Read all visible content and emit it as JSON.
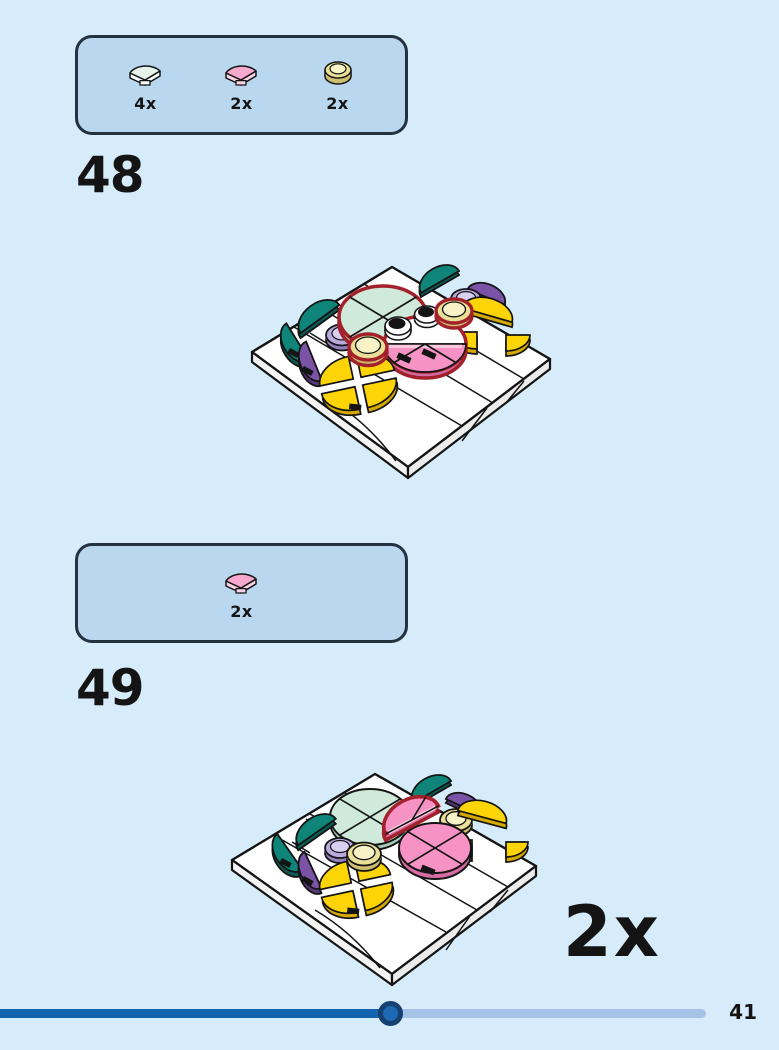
{
  "page": {
    "number": "41"
  },
  "palette": {
    "pageBg": "#d7ecfa",
    "boxBg": "#b9d8f0",
    "boxBorder": "#243240",
    "ink": "#141414",
    "red": "#a3212a",
    "mint": "#cfe9da",
    "mintSide": "#a9cdbb",
    "mintIcon": "#e6f3eb",
    "mintIconSide": "#f7fcf9",
    "teal": "#0f8478",
    "tealSide": "#0a5c54",
    "pink": "#f793c4",
    "pinkLight": "#fbc8de",
    "pinkSide": "#d66ba3",
    "pinkIcon": "#f6a8cd",
    "pinkIconSide": "#fbd2e5",
    "purple": "#7b53a6",
    "purpleSide": "#59397c",
    "lavender": "#b9a9dc",
    "lavenderLight": "#d9cff0",
    "lavenderSide": "#9480bd",
    "yellow": "#fdd405",
    "yellowSide": "#d5a900",
    "transY": "#eadf96",
    "transYLight": "#f8f3c6",
    "transYSide": "#cdbd6e",
    "barDark": "#1463ae",
    "barLight": "#a6c2e6",
    "dotFill": "#1d69b4",
    "dotRing": "#16406f"
  },
  "step48": {
    "number": "48",
    "parts": [
      {
        "piece": "quarter-circle-tile",
        "color": "light-aqua",
        "qty": "4x"
      },
      {
        "piece": "quarter-circle-tile",
        "color": "bright-pink",
        "qty": "2x"
      },
      {
        "piece": "round-tile",
        "color": "transparent-yellow",
        "qty": "2x"
      }
    ]
  },
  "step49": {
    "number": "49",
    "parts": [
      {
        "piece": "quarter-circle-tile",
        "color": "bright-pink",
        "qty": "2x"
      }
    ],
    "repeat_label": "2x"
  },
  "progress": {
    "percent_through_booklet": 55
  }
}
